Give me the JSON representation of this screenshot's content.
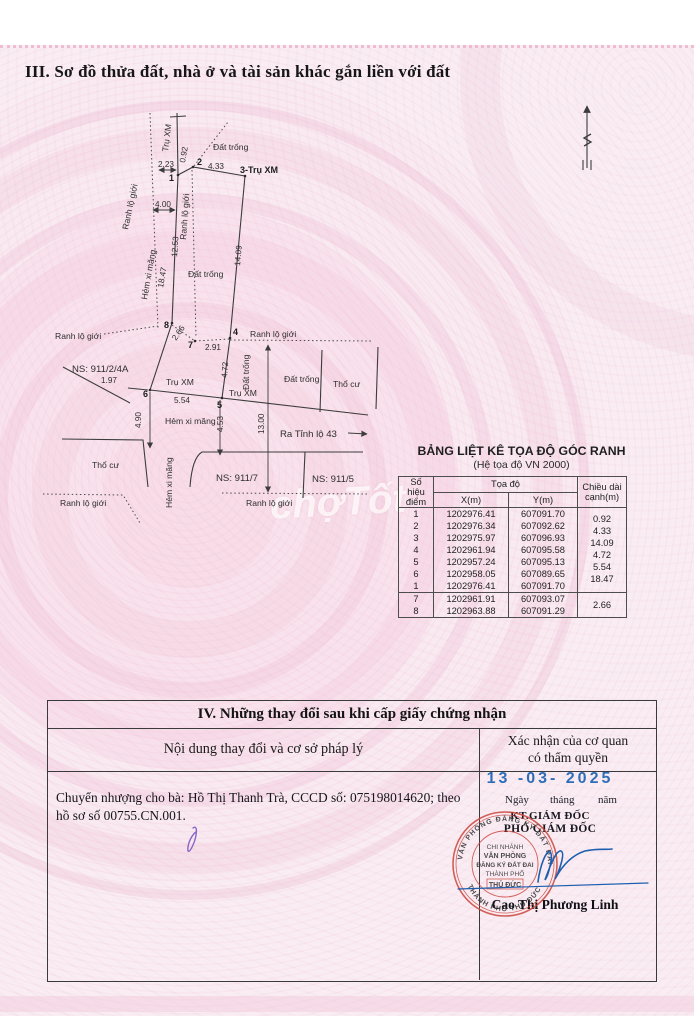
{
  "page": {
    "section3_title": "III. Sơ đồ thửa đất, nhà ở và tài sản khác gắn liền với đất"
  },
  "diagram": {
    "labels": {
      "ranh_lo_gioi": "Ranh lộ giới",
      "tru_xm": "Trụ XM",
      "point3_label": "3-Trụ XM",
      "dat_trong": "Đất trống",
      "tho_cu": "Thổ cư",
      "hem_xi_mang": "Hẻm xi măng",
      "ns_911_2_4a": "NS: 911/2/4A",
      "ns_911_7": "NS: 911/7",
      "ns_911_5": "NS: 911/5",
      "ra_tinh_lo": "Ra Tỉnh lộ 43"
    },
    "measures": {
      "m223": "2.23",
      "m092": "0.92",
      "m433": "4.33",
      "m400": "4.00",
      "m1253": "12.53",
      "m1847": "18.47",
      "m1409": "14.09",
      "m266": "2.66",
      "m291": "2.91",
      "m472": "4.72",
      "m197": "1.97",
      "m554": "5.54",
      "m490": "4.90",
      "m453": "4.53",
      "m1300": "13.00"
    },
    "points": {
      "p1": "1",
      "p2": "2",
      "p4": "4",
      "p5": "5",
      "p6": "6",
      "p7": "7",
      "p8": "8"
    }
  },
  "coord_table": {
    "title": "BẢNG LIỆT KÊ TỌA ĐỘ GÓC RANH",
    "subtitle": "(Hệ tọa độ VN 2000)",
    "headers": {
      "point": "Số hiệu điểm",
      "coords": "Tọa độ",
      "x": "X(m)",
      "y": "Y(m)",
      "length": "Chiều dài cạnh(m)"
    },
    "rows": [
      {
        "id": "1",
        "x": "1202976.41",
        "y": "607091.70",
        "len": "0.92"
      },
      {
        "id": "2",
        "x": "1202976.34",
        "y": "607092.62",
        "len": "4.33"
      },
      {
        "id": "3",
        "x": "1202975.97",
        "y": "607096.93",
        "len": "14.09"
      },
      {
        "id": "4",
        "x": "1202961.94",
        "y": "607095.58",
        "len": "4.72"
      },
      {
        "id": "5",
        "x": "1202957.24",
        "y": "607095.13",
        "len": "5.54"
      },
      {
        "id": "6",
        "x": "1202958.05",
        "y": "607089.65",
        "len": "18.47"
      },
      {
        "id": "1",
        "x": "1202976.41",
        "y": "607091.70",
        "len": ""
      },
      {
        "id": "7",
        "x": "1202961.91",
        "y": "607093.07",
        "len": "2.66"
      },
      {
        "id": "8",
        "x": "1202963.88",
        "y": "607091.29",
        "len": ""
      }
    ]
  },
  "section4": {
    "title": "IV. Những thay đổi sau khi cấp giấy chứng nhận",
    "col1_header": "Nội dung thay đổi và cơ sở pháp lý",
    "col2_header_line1": "Xác nhận của cơ quan",
    "col2_header_line2": "có thẩm quyền",
    "content": "Chuyển nhượng cho bà: Hồ Thị Thanh Trà, CCCD số: 075198014620; theo hồ sơ số 00755.CN.001.",
    "date": "13 -03- 2025",
    "date_caption_day": "Ngày",
    "date_caption_month": "tháng",
    "date_caption_year": "năm",
    "signer_title1": "KT.GIÁM ĐỐC",
    "signer_title2": "PHÓ GIÁM ĐỐC",
    "signer_name": "Cao Thị Phương Linh",
    "stamp": {
      "line1": "CHI NHÁNH",
      "line2": "VĂN PHÒNG",
      "line3": "ĐĂNG KÝ ĐẤT ĐAI",
      "line4": "THÀNH PHỐ",
      "line5": "THỦ ĐỨC",
      "ring_top": "VĂN PHÒNG ĐĂNG KÝ ĐẤT ĐAI",
      "ring_bottom": "THÀNH PHỐ THỦ ĐỨC"
    }
  },
  "watermark": "chợTốt",
  "colors": {
    "sheet_pink": "#f9edf3",
    "line_gray": "#3c3c3c",
    "stamp_red": "#cc463c",
    "date_blue": "#2e6db8",
    "signature_blue": "#1d5fae",
    "signature_purple": "#8766c8"
  }
}
